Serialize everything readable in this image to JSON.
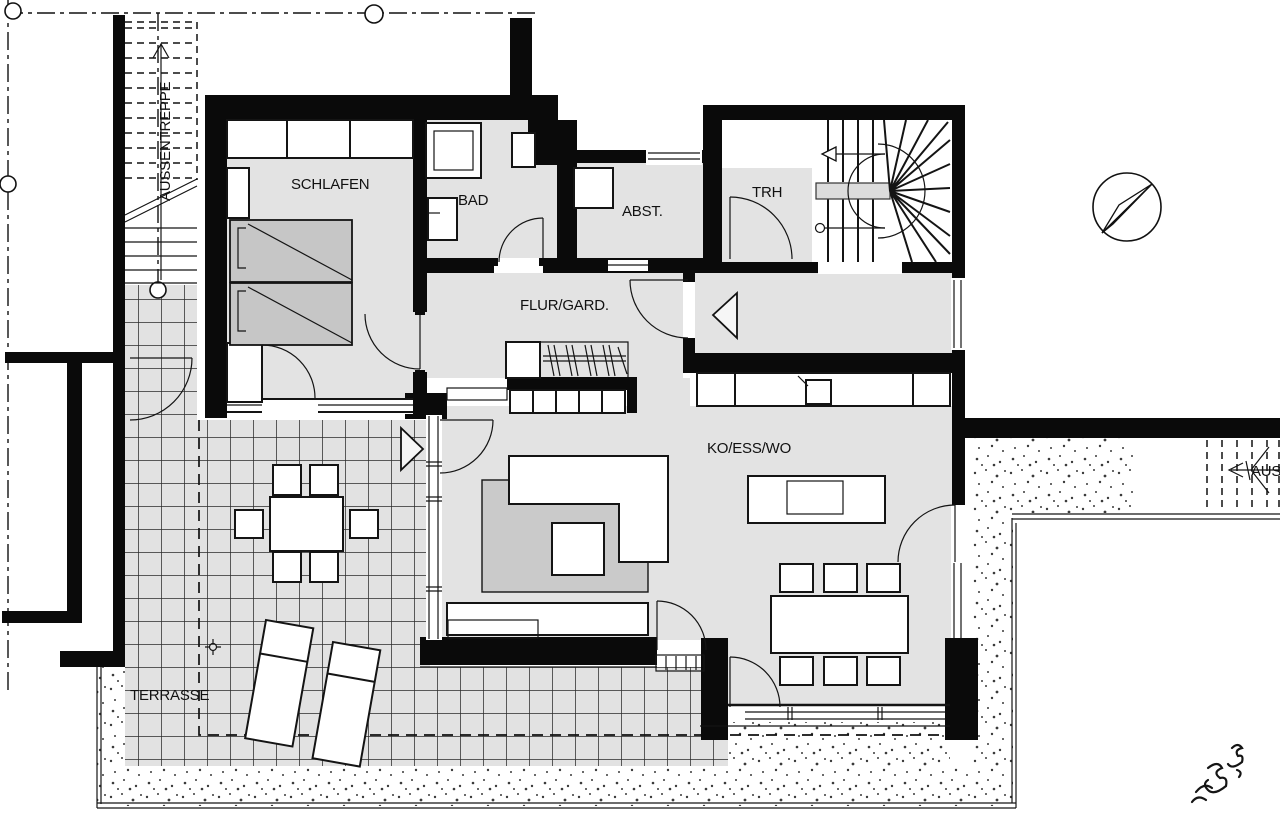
{
  "rooms": {
    "schlafen": {
      "label": "SCHLAFEN"
    },
    "bad": {
      "label": "BAD"
    },
    "abst": {
      "label": "ABST."
    },
    "trh": {
      "label": "TRH"
    },
    "flur": {
      "label": "FLUR/GARD."
    },
    "wohnen": {
      "label": "KO/ESS/WO"
    },
    "terrasse": {
      "label": "TERRASSE"
    }
  },
  "stairs": {
    "left": {
      "label": "AUSSENTREPPE"
    },
    "right": {
      "label": "AUSSENTREPPE"
    }
  },
  "icons": {
    "compass": "north-arrow-compass",
    "entry_arrow": "entrance-direction-arrow",
    "terrace_arrow": "terrace-entrance-arrow",
    "stair_direction_arrow": "stair-up-arrow"
  },
  "colors": {
    "wall": "#0a0a0a",
    "room_fill": "#e3e3e3",
    "furniture_gray": "#c6c6c6",
    "rug": "#cacaca",
    "compass_needle_gray": "#9b9b9b"
  }
}
